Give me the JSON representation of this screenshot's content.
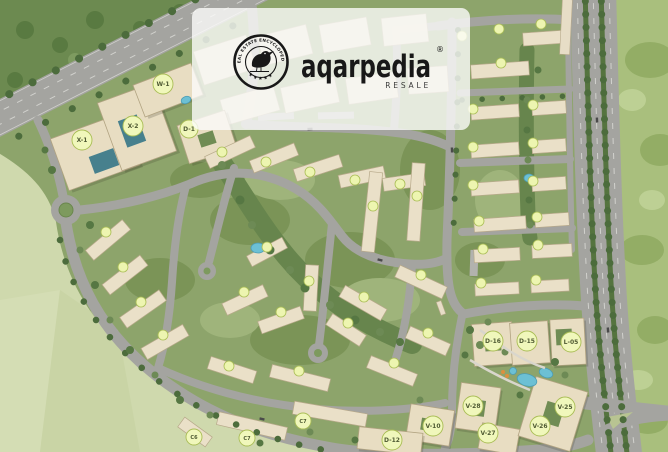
{
  "watermark": {
    "brand": "aqarpedia",
    "registered_mark": "®",
    "tagline": "RESALE",
    "badge": {
      "top_text": "REAL ESTATE ENCYCLOPEDIA",
      "stars": "★★★★★",
      "icon": "bird-icon"
    }
  },
  "map": {
    "unit_labels": [
      {
        "text": "W-1"
      },
      {
        "text": "X-2"
      },
      {
        "text": "X-1"
      },
      {
        "text": "D-1"
      },
      {
        "text": "D-16"
      },
      {
        "text": "D-15"
      },
      {
        "text": "L-05"
      },
      {
        "text": "V-28"
      },
      {
        "text": "V-25"
      },
      {
        "text": "V-26"
      },
      {
        "text": "V-27"
      },
      {
        "text": "V-10"
      },
      {
        "text": "D-12"
      },
      {
        "text": "C6"
      },
      {
        "text": "C7"
      },
      {
        "text": "C7"
      }
    ],
    "colors": {
      "label_bg": "#f0f7bb",
      "label_border": "#a9bd55",
      "building": "#eae0c8",
      "road": "#a4a4a0",
      "water": "#6cc0d4",
      "field": "#cfd9ad",
      "golf": "#a9bf7d",
      "dense_green": "#6c8a50",
      "watermark_card": "#fbfbfa"
    }
  }
}
